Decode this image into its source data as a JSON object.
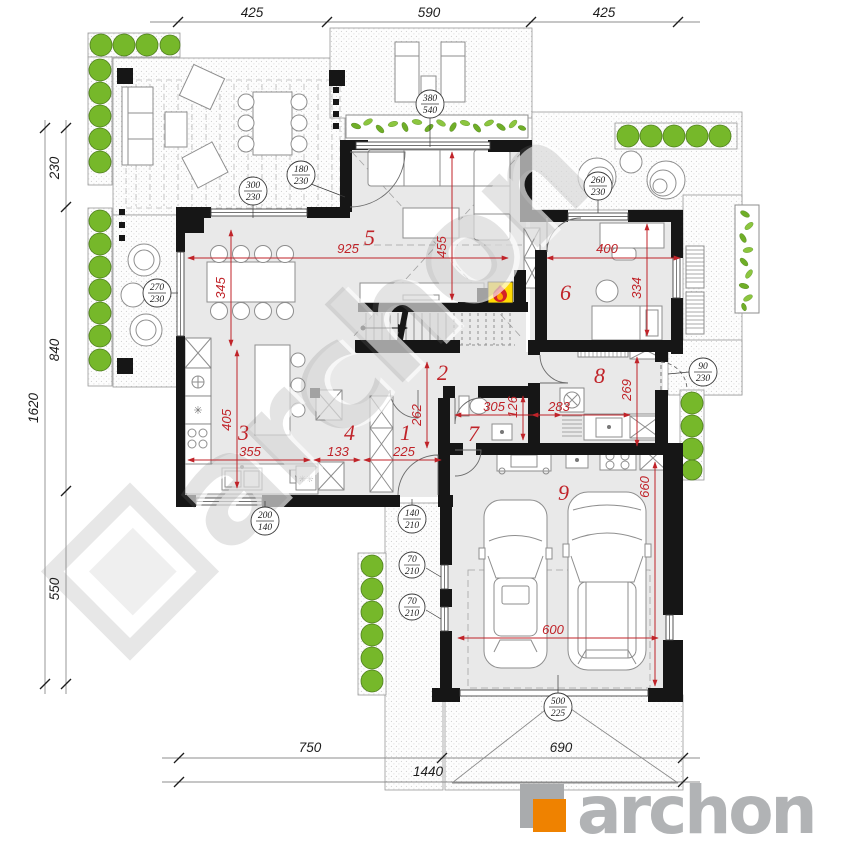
{
  "plan": {
    "watermark": "archon",
    "logo": {
      "brand": "archon"
    },
    "colors": {
      "wall": "#161616",
      "dim_red": "#c02329",
      "green": "#76b82a",
      "orange": "#ef8200",
      "logo_gray": "#b1b3b5",
      "floor": "#e9e9e9"
    },
    "rooms": [
      {
        "num": "1"
      },
      {
        "num": "2"
      },
      {
        "num": "3"
      },
      {
        "num": "4"
      },
      {
        "num": "5"
      },
      {
        "num": "6"
      },
      {
        "num": "7"
      },
      {
        "num": "8"
      },
      {
        "num": "9"
      }
    ],
    "outer": {
      "top": [
        "425",
        "590",
        "425"
      ],
      "left_total": "1620",
      "left": [
        "230",
        "840",
        "550"
      ],
      "bottom": [
        "750",
        "690",
        "1440"
      ]
    },
    "red_dims": [
      "925",
      "455",
      "345",
      "400",
      "334",
      "405",
      "355",
      "133",
      "225",
      "262",
      "305",
      "126",
      "283",
      "269",
      "660",
      "600"
    ],
    "openings": [
      {
        "w": "380",
        "h": "540"
      },
      {
        "w": "300",
        "h": "230"
      },
      {
        "w": "180",
        "h": "230"
      },
      {
        "w": "270",
        "h": "230"
      },
      {
        "w": "260",
        "h": "230"
      },
      {
        "w": "90",
        "h": "230"
      },
      {
        "w": "200",
        "h": "140"
      },
      {
        "w": "140",
        "h": "210"
      },
      {
        "w": "70",
        "h": "210"
      },
      {
        "w": "70",
        "h": "210"
      },
      {
        "w": "500",
        "h": "225"
      }
    ]
  }
}
